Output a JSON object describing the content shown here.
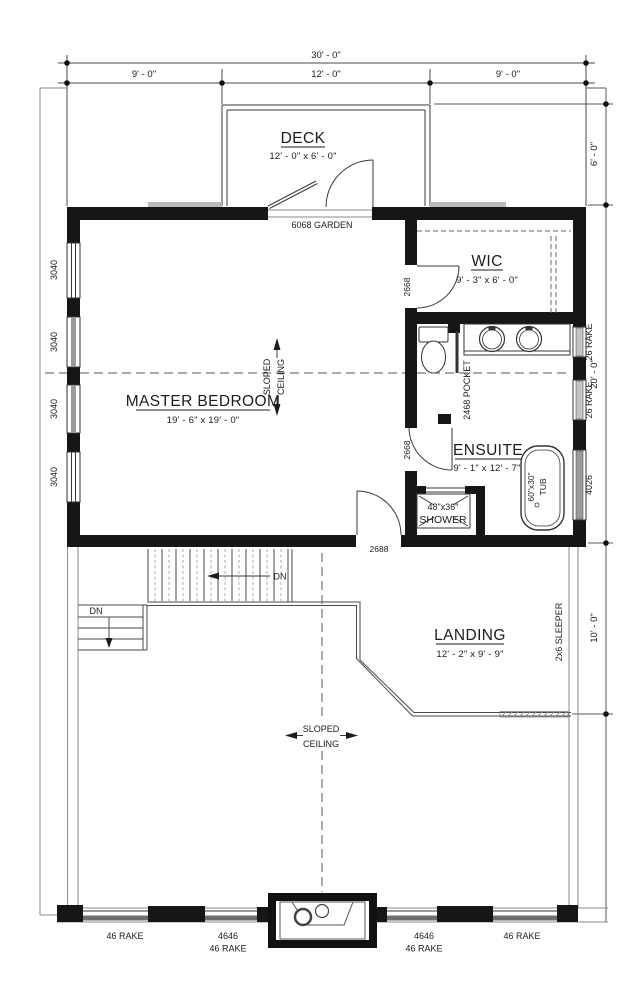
{
  "rooms": {
    "deck": {
      "name": "DECK",
      "dims": "12' - 0\" x 6' - 0\""
    },
    "master_bedroom": {
      "name": "MASTER BEDROOM",
      "dims": "19' - 6\" x 19' - 0\""
    },
    "wic": {
      "name": "WIC",
      "dims": "9' - 3\" x 6' - 0\""
    },
    "ensuite": {
      "name": "ENSUITE",
      "dims": "9' - 1\" x 12' - 7\""
    },
    "landing": {
      "name": "LANDING",
      "dims": "12' - 2\" x 9' - 9\""
    }
  },
  "dimensions": {
    "overall_width": "30' - 0\"",
    "top_left": "9' - 0\"",
    "top_mid": "12' - 0\"",
    "top_right": "9' - 0\"",
    "right_deck": "6' - 0\"",
    "right_upper": "20' - 0\"",
    "right_lower": "10' - 0\""
  },
  "doors": {
    "garden": "6068 GARDEN",
    "wic": "2668",
    "pocket": "2468 POCKET",
    "ensuite": "2668",
    "bedroom": "2688"
  },
  "windows": {
    "left": [
      "3040",
      "3040",
      "3040",
      "3040"
    ],
    "right": [
      "26 RAKE",
      "26 RAKE",
      "4026"
    ],
    "bottom_far_left": "46 RAKE",
    "bottom_left_1": "4646",
    "bottom_left_2": "46 RAKE",
    "bottom_right_1": "4646",
    "bottom_right_2": "46 RAKE",
    "bottom_far_right": "46 RAKE"
  },
  "fixtures": {
    "shower_size": "48\"x36\"",
    "shower_label": "SHOWER",
    "tub_size": "60\"x30\"",
    "tub_label": "TUB"
  },
  "annotations": {
    "sloped": "SLOPED",
    "ceiling": "CEILING",
    "sleeper": "2x6 SLEEPER",
    "down": "DN"
  },
  "colors": {
    "wall": "#161616",
    "thin_line": "#3a3a3a",
    "light_line": "#8a8a8a",
    "window_gray": "#9a9a9a"
  }
}
